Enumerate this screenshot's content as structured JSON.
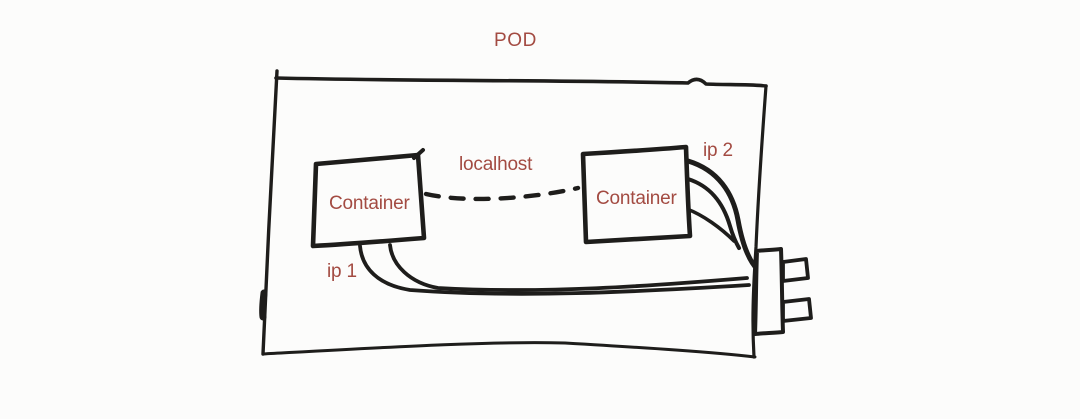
{
  "diagram": {
    "title": "POD",
    "pod": {
      "link_label": "localhost",
      "container_left": {
        "label": "Container",
        "ip_label": "ip 1"
      },
      "container_right": {
        "label": "Container",
        "ip_label": "ip 2"
      },
      "plug_icon": "network-plug"
    },
    "colors": {
      "ink": "#1e1d1b",
      "label": "#a34b42",
      "background": "#fcfcfb"
    }
  }
}
